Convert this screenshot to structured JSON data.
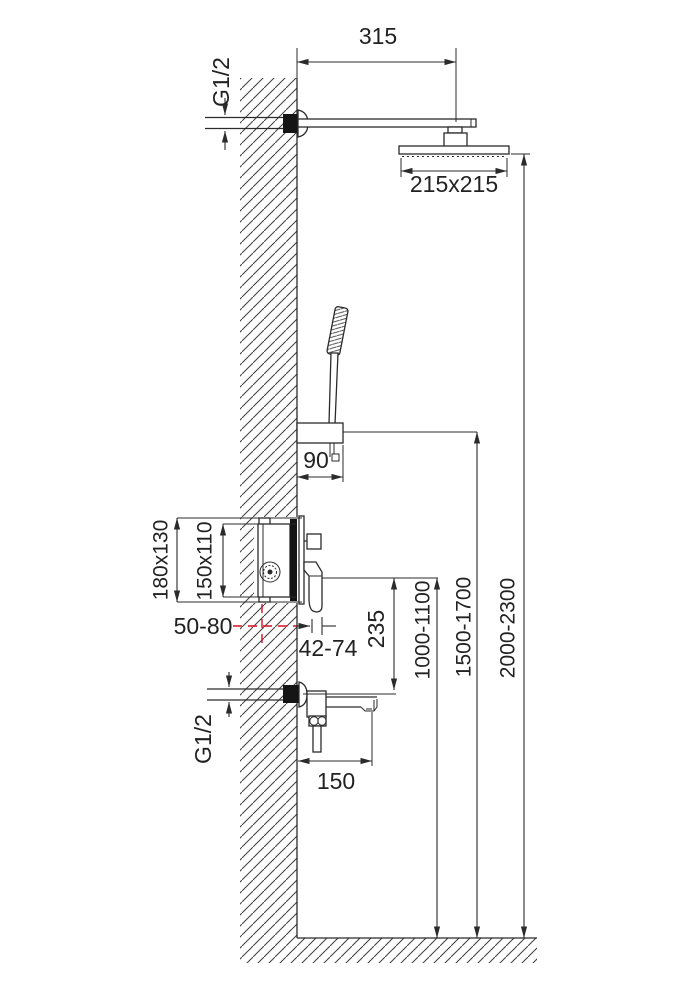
{
  "drawing": {
    "type": "technical-installation-diagram",
    "subject": "wall-mounted shower system with overhead shower, hand shower, concealed mixer and tub spout"
  },
  "colors": {
    "line": "#2b2b2b",
    "accent_red": "#d60f1f",
    "fill_dark": "#151515",
    "background": "#ffffff"
  },
  "dimensions": {
    "arm_length": "315",
    "top_thread": "G1/2",
    "head_size": "215x215",
    "holder_width": "90",
    "valve_outer": "180x130",
    "valve_inner": "150x110",
    "embed_depth": "50-80",
    "trim_depth": "42-74",
    "valve_to_spout": "235",
    "valve_height": "1000-1100",
    "holder_height": "1500-1700",
    "head_height": "2000-2300",
    "bottom_thread": "G1/2",
    "spout_length": "150"
  }
}
